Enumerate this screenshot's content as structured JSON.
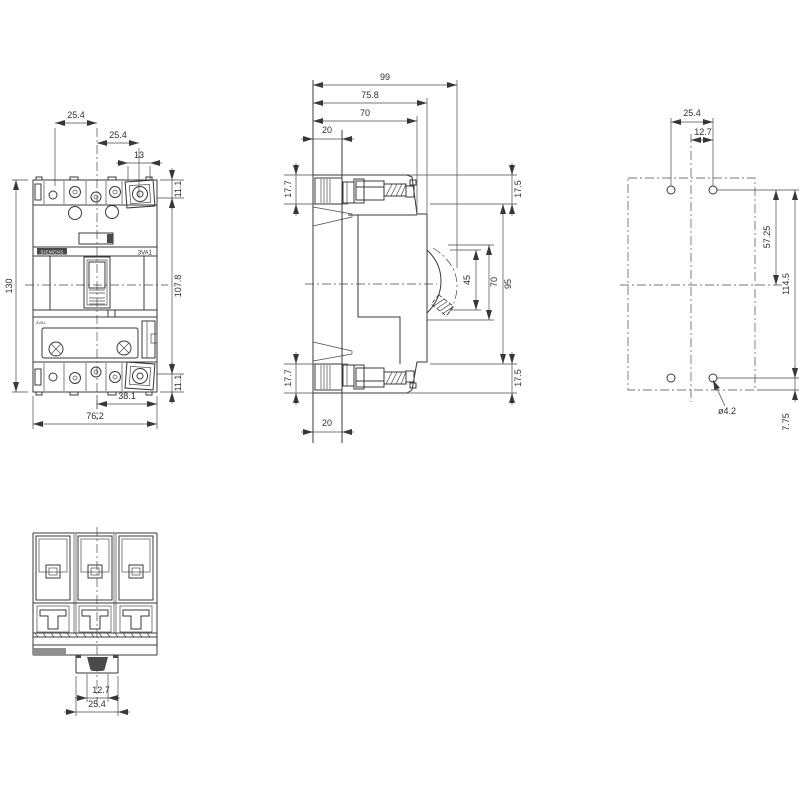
{
  "drawing": {
    "type": "dimension-drawing",
    "views": {
      "front": "front view",
      "side": "side view",
      "rear": "mounting hole pattern",
      "bottom": "bottom terminal view"
    }
  },
  "labels": {
    "brand": "SIEMENS",
    "product": "3VA1",
    "fine_print": "3VA1"
  },
  "dims": {
    "fv_pitch1": "25.4",
    "fv_pitch2": "25.4",
    "fv_term_w": "13",
    "fv_top_off": "11.1",
    "fv_height": "130",
    "fv_span": "107.8",
    "fv_bot_off": "11.1",
    "fv_half": "38.1",
    "fv_width": "76.2",
    "sv_depth": "99",
    "sv_d758": "75.8",
    "sv_d70": "70",
    "sv_rail_top": "20",
    "sv_t177_top": "17.7",
    "sv_t175_top": "17.5",
    "sv_h45": "45",
    "sv_h70": "70",
    "sv_h95": "95",
    "sv_t177_bot": "17.7",
    "sv_t175_bot": "17.5",
    "sv_rail_bot": "20",
    "rv_pitch": "25.4",
    "rv_half": "12.7",
    "rv_upper": "57.25",
    "rv_span": "114.5",
    "rv_edge": "7.75",
    "rv_dia": "ø4.2",
    "bv_half": "12.7",
    "bv_full": "25.4"
  }
}
